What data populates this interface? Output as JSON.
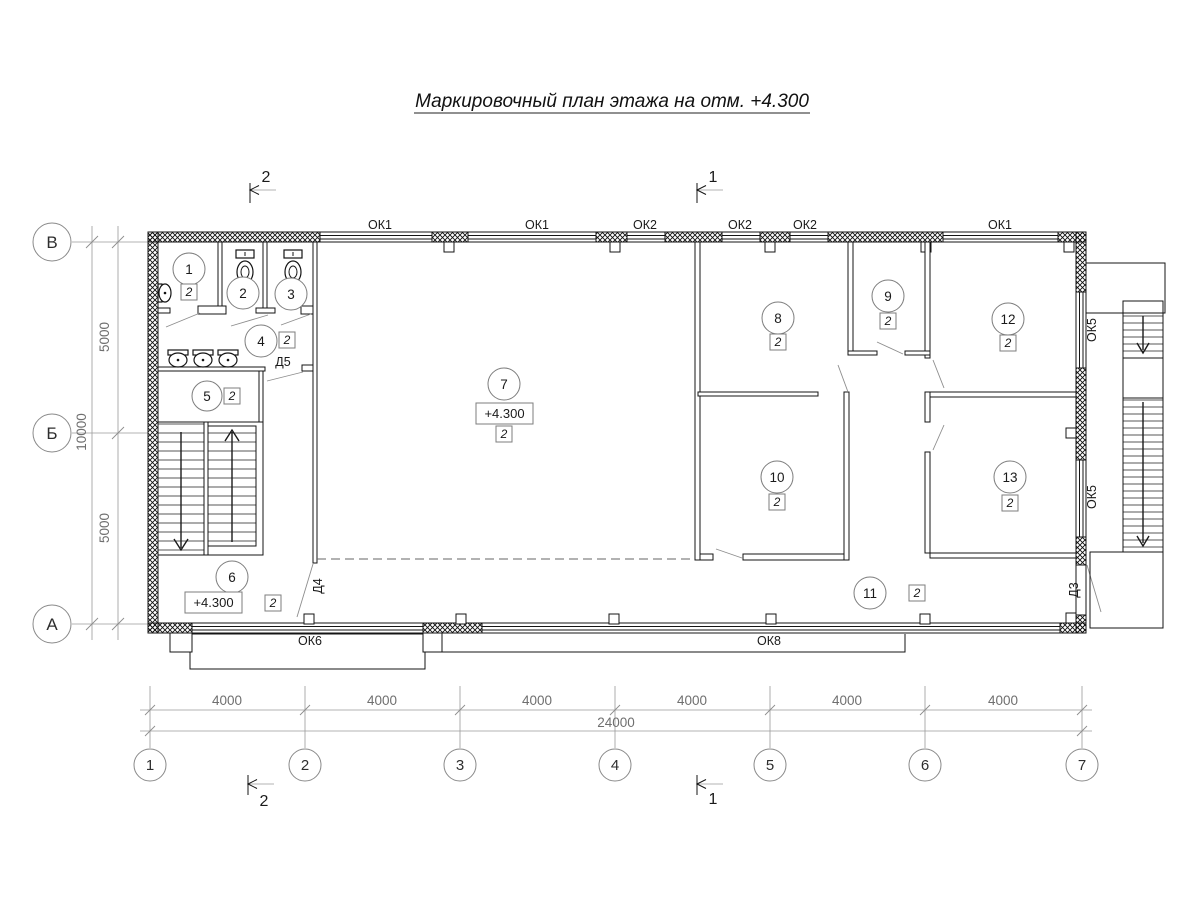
{
  "title": "Маркировочный план этажа на отм. +4.300",
  "axes": {
    "vertical": [
      "В",
      "Б",
      "А"
    ],
    "horizontal": [
      "1",
      "2",
      "3",
      "4",
      "5",
      "6",
      "7"
    ]
  },
  "dimensions": {
    "bottom_bays": [
      "4000",
      "4000",
      "4000",
      "4000",
      "4000",
      "4000"
    ],
    "bottom_total": "24000",
    "left_upper": "5000",
    "left_lower": "5000",
    "left_total": "10000"
  },
  "section_marks": {
    "top_left": "2",
    "top_right": "1",
    "bottom_left": "2",
    "bottom_right": "1"
  },
  "windows": {
    "top": [
      "ОК1",
      "ОК1",
      "ОК2",
      "ОК2",
      "ОК2",
      "ОК1"
    ],
    "right": [
      "ОК5",
      "ОК5"
    ],
    "bottom": [
      "ОК6",
      "ОК8"
    ]
  },
  "doors": {
    "d5": "Д5",
    "d4": "Д4",
    "d3": "Д3"
  },
  "rooms": [
    {
      "number": "1",
      "mark": "2"
    },
    {
      "number": "2"
    },
    {
      "number": "3"
    },
    {
      "number": "4",
      "mark": "2"
    },
    {
      "number": "5",
      "mark": "2"
    },
    {
      "number": "6",
      "mark": "2",
      "elevation": "+4.300"
    },
    {
      "number": "7",
      "mark": "2",
      "elevation": "+4.300"
    },
    {
      "number": "8",
      "mark": "2"
    },
    {
      "number": "9",
      "mark": "2"
    },
    {
      "number": "10",
      "mark": "2"
    },
    {
      "number": "11",
      "mark": "2"
    },
    {
      "number": "12",
      "mark": "2"
    },
    {
      "number": "13",
      "mark": "2"
    }
  ]
}
